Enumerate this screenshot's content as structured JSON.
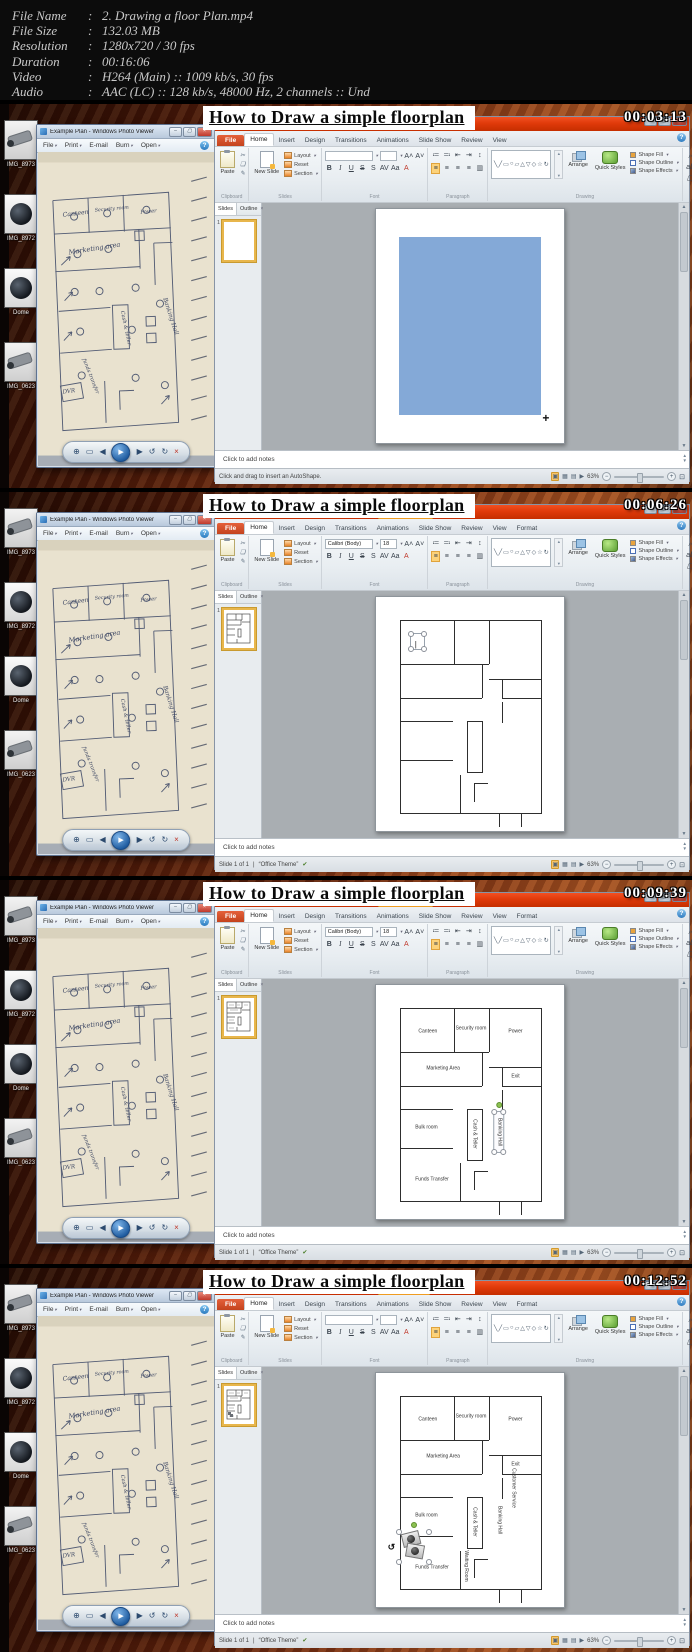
{
  "meta": {
    "rows": [
      {
        "label": "File Name",
        "value": "2. Drawing a floor Plan.mp4"
      },
      {
        "label": "File Size",
        "value": "132.03 MB"
      },
      {
        "label": "Resolution",
        "value": "1280x720 / 30 fps"
      },
      {
        "label": "Duration",
        "value": "00:16:06"
      },
      {
        "label": "Video",
        "value": "H264 (Main) :: 1009 kb/s, 30 fps"
      },
      {
        "label": "Audio",
        "value": "AAC (LC) :: 128 kb/s, 48000 Hz, 2 channels :: Und"
      }
    ]
  },
  "shared": {
    "banner_title": "How to Draw a simple floorplan",
    "desktop_icons": [
      "IMG_8973",
      "IMG_8972",
      "Dome",
      "IMG_0623"
    ],
    "photo_viewer": {
      "title": "Example Plan - Windows Photo Viewer",
      "menus": [
        "File",
        "Print",
        "E-mail",
        "Burn",
        "Open"
      ],
      "help_icon": "?",
      "icons": {
        "zoom": "⊕",
        "actual_size": "▭",
        "previous": "◀",
        "play": "▶",
        "next": "▶",
        "rotate_ccw": "↺",
        "rotate_cw": "↻",
        "delete": "×"
      },
      "sketch": {
        "canteen": "Canteen",
        "security": "Security room",
        "power": "Power",
        "marketing": "Marketing area",
        "cash": "Cash & teller",
        "banking": "Banking Hall",
        "funds": "funds transfer",
        "dvr": "DVR"
      }
    },
    "ppt": {
      "window_title": "Microsoft PowerPoint",
      "tabs": [
        "File",
        "Home",
        "Insert",
        "Design",
        "Transitions",
        "Animations",
        "Slide Show",
        "Review",
        "View"
      ],
      "format_tab": "Format",
      "groups": [
        "Clipboard",
        "Slides",
        "Font",
        "Paragraph",
        "Drawing",
        "Editing"
      ],
      "buttons": {
        "paste": "Paste",
        "new_slide": "New Slide",
        "layout": "Layout",
        "reset": "Reset",
        "section": "Section",
        "arrange": "Arrange",
        "quick_styles": "Quick Styles",
        "shape_fill": "Shape Fill",
        "shape_outline": "Shape Outline",
        "shape_effects": "Shape Effects",
        "find": "Find",
        "replace": "Replace",
        "select": "Select"
      },
      "slides_tab": "Slides",
      "outline_tab": "Outline",
      "slide_number": "1",
      "notes_placeholder": "Click to add notes",
      "zoom_level": "63%",
      "accent_red": "#e03a0a",
      "context_tab_orange": "#ef9a1d",
      "slide_fill_blue": "#84a9d7"
    }
  },
  "frames": [
    {
      "timestamp": "00:03:13",
      "context_tab": "",
      "font_name": "",
      "font_size": "",
      "status_left": "Click and drag to insert an AutoShape.",
      "theme": "",
      "bluerect": 1,
      "plan": 0,
      "tbox": 0,
      "pic": 0,
      "thumbtext": 0,
      "labels": []
    },
    {
      "timestamp": "00:06:26",
      "context_tab": "Drawing Tools",
      "font_name": "Calibri (Body)",
      "font_size": "18",
      "status_left": "Slide 1 of 1",
      "theme": "“Office Theme”",
      "bluerect": 0,
      "plan": 1,
      "tbox": 1,
      "pic": 0,
      "thumbtext": 0,
      "labels": []
    },
    {
      "timestamp": "00:09:39",
      "context_tab": "Drawing Tools",
      "font_name": "Calibri (Body)",
      "font_size": "18",
      "status_left": "Slide 1 of 1",
      "theme": "“Office Theme”",
      "bluerect": 0,
      "plan": 1,
      "tbox": 0,
      "pic": 0,
      "thumbtext": 1,
      "labels": [
        {
          "text": "Canteen",
          "x": 19,
          "y": 12
        },
        {
          "text": "Security room",
          "x": 50,
          "y": 10
        },
        {
          "text": "Power",
          "x": 82,
          "y": 12
        },
        {
          "text": "Marketing Area",
          "x": 30,
          "y": 31
        },
        {
          "text": "Exit",
          "x": 82,
          "y": 35
        },
        {
          "text": "Bulk room",
          "x": 18,
          "y": 62
        },
        {
          "text": "Cash & Teller",
          "x": 52,
          "y": 65,
          "v": 1
        },
        {
          "text": "Banking Hall",
          "x": 70,
          "y": 64,
          "v": 1,
          "sel": 1
        },
        {
          "text": "Funds Transfer",
          "x": 22,
          "y": 89
        }
      ]
    },
    {
      "timestamp": "00:12:52",
      "context_tab": "Picture Tools",
      "font_name": "",
      "font_size": "",
      "status_left": "Slide 1 of 1",
      "theme": "“Office Theme”",
      "bluerect": 0,
      "plan": 1,
      "tbox": 0,
      "pic": 1,
      "thumbtext": 1,
      "labels": [
        {
          "text": "Canteen",
          "x": 19,
          "y": 12
        },
        {
          "text": "Security room",
          "x": 50,
          "y": 10
        },
        {
          "text": "Power",
          "x": 82,
          "y": 12
        },
        {
          "text": "Marketing Area",
          "x": 30,
          "y": 31
        },
        {
          "text": "Exit",
          "x": 82,
          "y": 35
        },
        {
          "text": "Customer Service",
          "x": 80,
          "y": 47,
          "v": 1
        },
        {
          "text": "Bulk room",
          "x": 18,
          "y": 62
        },
        {
          "text": "Cash & Teller",
          "x": 52,
          "y": 65,
          "v": 1
        },
        {
          "text": "Banking Hall",
          "x": 70,
          "y": 64,
          "v": 1
        },
        {
          "text": "Waiting Room",
          "x": 46,
          "y": 88,
          "v": 1
        },
        {
          "text": "Funds Transfer",
          "x": 22,
          "y": 89
        }
      ]
    }
  ]
}
